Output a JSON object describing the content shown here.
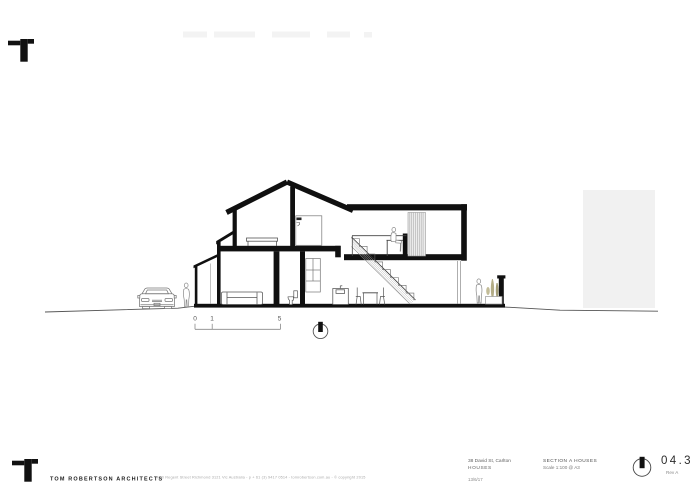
{
  "title_block": {
    "firm_name": "TOM ROBERTSON ARCHITECTS",
    "firm_details": "4/40 Regent Street Richmond 3121 Vic Australia   -   p + 61 (3) 9417 0514   -   tomrobertson.com.au   -   © copyright 2015",
    "project_address": "38 David St, Carlton",
    "project_name": "HOUSES",
    "date": "13/6/17",
    "drawing_title": "SECTION A HOUSES",
    "drawing_scale": "Scale 1:100 @ A3",
    "sheet_number": "04.3",
    "revision": "Rev A"
  },
  "scale_bar": {
    "labels": [
      "0",
      "1",
      "5"
    ]
  },
  "colors": {
    "ink": "#101010",
    "thin_line": "#555555",
    "faint_block": "#f3f3f3",
    "neighbor_building": "#f1f1f1",
    "plant": "#aaa47e"
  }
}
